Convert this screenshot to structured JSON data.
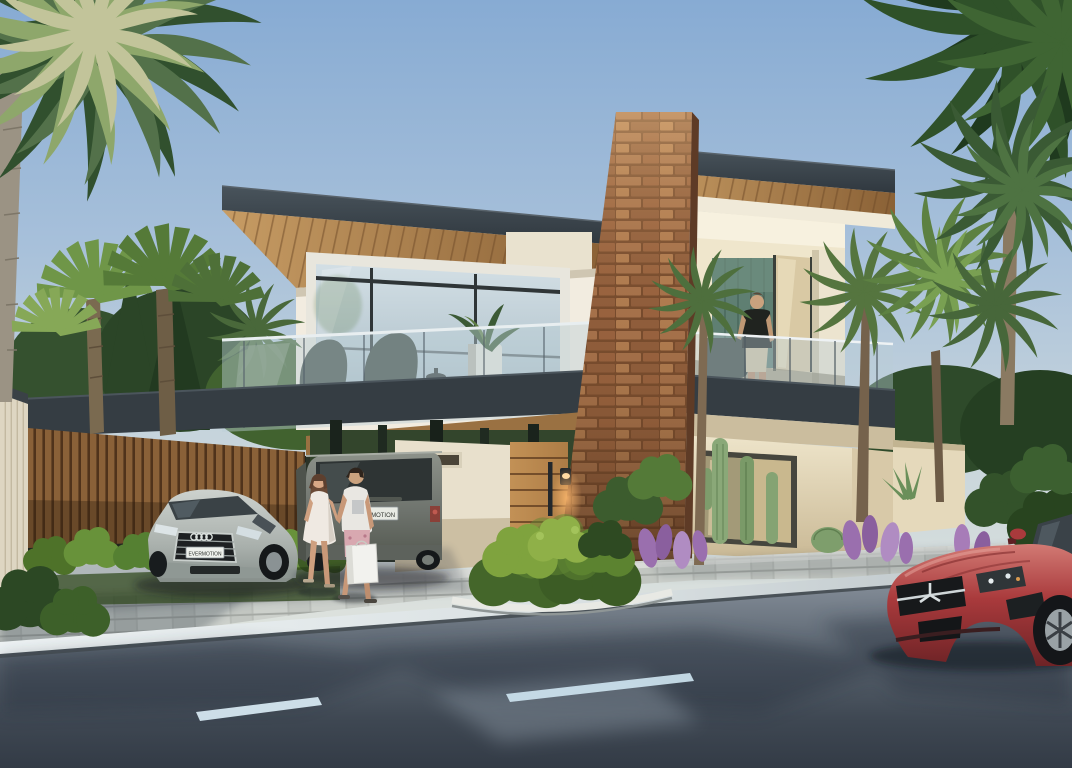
{
  "scene": {
    "description": "Photorealistic exterior rendering of a modern two-story villa with carport, glass balconies, stone chimney column, palm trees, two pedestrians, parked cars and a red sports car on a sunlit street"
  },
  "vehicles": {
    "audi_plate": "EVERMOTION",
    "suv_plate": "EVERMOTION"
  },
  "colors": {
    "sky_top": "#87abd3",
    "sky_horizon": "#dfe3dd",
    "roof_fascia": "#3a434b",
    "soffit_wood": "#b5854f",
    "wall_cream": "#efe8d6",
    "brick_stone": "#9c6c49",
    "accent_band": "#353d43",
    "glass_blue": "#c3d3dc",
    "interior_green_panel": "#5f7f72",
    "string_light_warm": "#ffd9a2",
    "hedge_green": "#5d8136",
    "palm_dark": "#31502e",
    "palm_light": "#8ea76b",
    "road_asphalt": "#4a5560",
    "lane_marking": "#d9ebf5",
    "pavement_gray": "#c9ccc8",
    "audi_silver": "#b4b9b6",
    "suv_gray": "#6e736d",
    "mercedes_red": "#a93a3c",
    "purple_flowers": "#9a6fae"
  }
}
